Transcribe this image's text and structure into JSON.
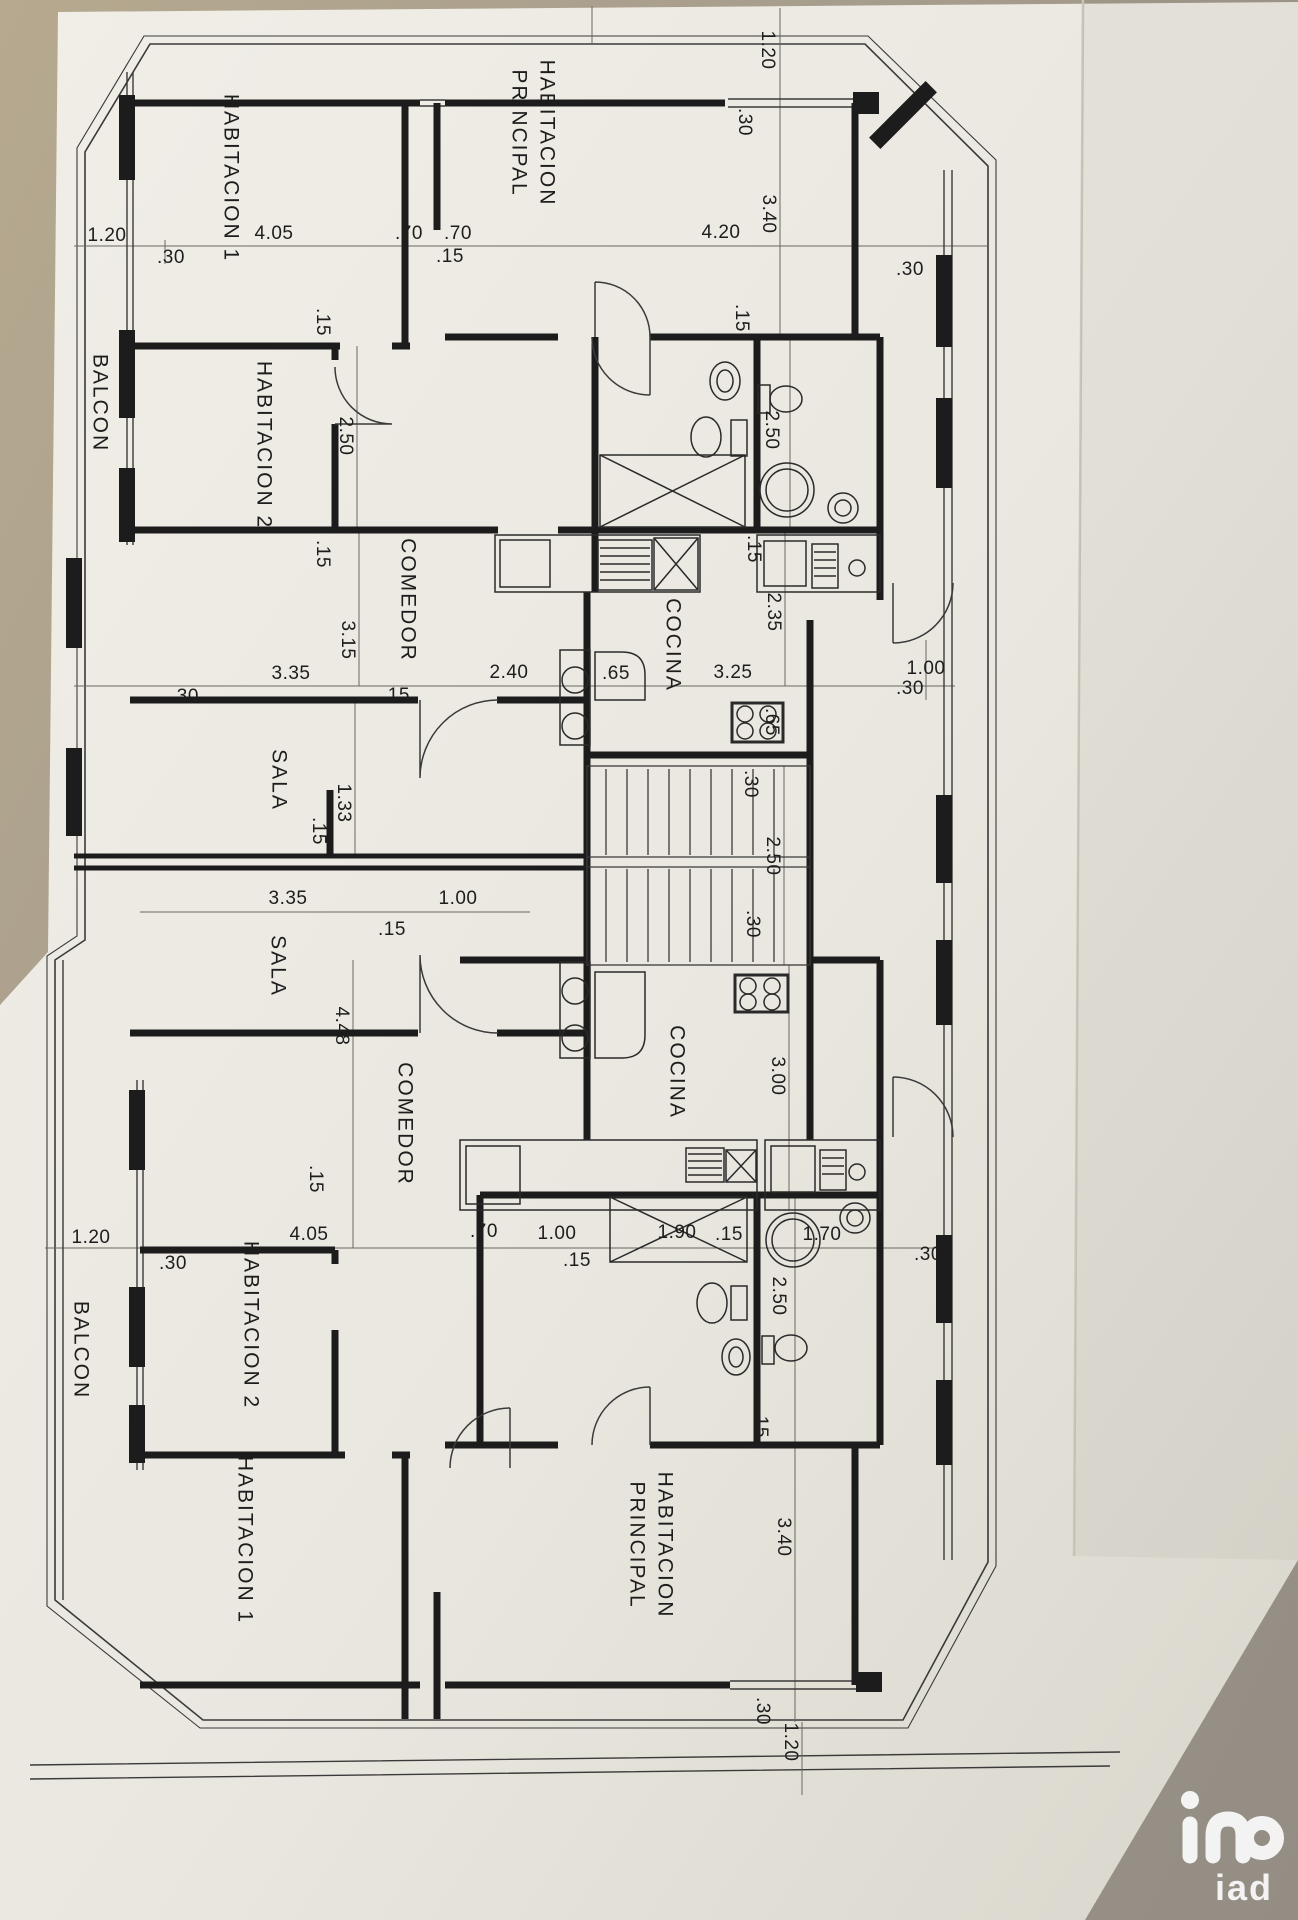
{
  "scene": {
    "table_color": "#a89e8d",
    "paper_color": "#eceae2",
    "wall_color": "#1c1c1c",
    "thin_line_color": "#3a3a3a",
    "dim_line_color": "#6a675f",
    "watermark_color": "#ffffff"
  },
  "watermark": {
    "text": "iad"
  },
  "plan": {
    "room_labels": [
      {
        "text": "HABITACION 1",
        "x": 230,
        "y": 178,
        "rot": 90
      },
      {
        "text": "PRINCIPAL",
        "x": 518,
        "y": 133,
        "rot": 90
      },
      {
        "text": "HABITACION",
        "x": 546,
        "y": 133,
        "rot": 90
      },
      {
        "text": "HABITACION 2",
        "x": 263,
        "y": 445,
        "rot": 90
      },
      {
        "text": "COMEDOR",
        "x": 407,
        "y": 600,
        "rot": 90
      },
      {
        "text": "COCINA",
        "x": 672,
        "y": 645,
        "rot": 90
      },
      {
        "text": "SALA",
        "x": 278,
        "y": 780,
        "rot": 90
      },
      {
        "text": "SALA",
        "x": 277,
        "y": 966,
        "rot": 90
      },
      {
        "text": "COCINA",
        "x": 676,
        "y": 1072,
        "rot": 90
      },
      {
        "text": "COMEDOR",
        "x": 404,
        "y": 1124,
        "rot": 90
      },
      {
        "text": "HABITACION 2",
        "x": 250,
        "y": 1325,
        "rot": 90
      },
      {
        "text": "HABITACION 1",
        "x": 244,
        "y": 1540,
        "rot": 90
      },
      {
        "text": "PRINCIPAL",
        "x": 636,
        "y": 1545,
        "rot": 90
      },
      {
        "text": "HABITACION",
        "x": 664,
        "y": 1545,
        "rot": 90
      },
      {
        "text": "BALCON",
        "x": 99,
        "y": 403,
        "rot": 90
      },
      {
        "text": "BALCON",
        "x": 80,
        "y": 1350,
        "rot": 90
      }
    ],
    "dim_labels": [
      {
        "text": "1.20",
        "x": 107,
        "y": 236,
        "rot": 0
      },
      {
        "text": ".30",
        "x": 171,
        "y": 258,
        "rot": 0
      },
      {
        "text": "4.05",
        "x": 274,
        "y": 234,
        "rot": 0
      },
      {
        "text": ".70",
        "x": 409,
        "y": 234,
        "rot": 0
      },
      {
        "text": ".70",
        "x": 458,
        "y": 234,
        "rot": 0
      },
      {
        "text": ".15",
        "x": 450,
        "y": 257,
        "rot": 0
      },
      {
        "text": "4.20",
        "x": 721,
        "y": 233,
        "rot": 0
      },
      {
        "text": "1.20",
        "x": 767,
        "y": 50,
        "rot": 90
      },
      {
        "text": ".30",
        "x": 744,
        "y": 122,
        "rot": 90
      },
      {
        "text": "3.40",
        "x": 768,
        "y": 214,
        "rot": 90
      },
      {
        "text": ".30",
        "x": 910,
        "y": 270,
        "rot": 0
      },
      {
        "text": ".15",
        "x": 322,
        "y": 322,
        "rot": 90
      },
      {
        "text": "2.50",
        "x": 345,
        "y": 436,
        "rot": 90
      },
      {
        "text": ".15",
        "x": 322,
        "y": 554,
        "rot": 90
      },
      {
        "text": ".15",
        "x": 741,
        "y": 318,
        "rot": 90
      },
      {
        "text": "2.50",
        "x": 771,
        "y": 430,
        "rot": 90
      },
      {
        "text": ".15",
        "x": 753,
        "y": 549,
        "rot": 90
      },
      {
        "text": "2.35",
        "x": 773,
        "y": 612,
        "rot": 90
      },
      {
        "text": "3.35",
        "x": 291,
        "y": 674,
        "rot": 0
      },
      {
        "text": "3.15",
        "x": 347,
        "y": 640,
        "rot": 90
      },
      {
        "text": ".30",
        "x": 185,
        "y": 697,
        "rot": 0
      },
      {
        "text": ".15",
        "x": 396,
        "y": 696,
        "rot": 0
      },
      {
        "text": "2.40",
        "x": 509,
        "y": 673,
        "rot": 0
      },
      {
        "text": ".65",
        "x": 616,
        "y": 674,
        "rot": 0
      },
      {
        "text": "3.25",
        "x": 733,
        "y": 673,
        "rot": 0
      },
      {
        "text": "1.00",
        "x": 926,
        "y": 669,
        "rot": 0
      },
      {
        "text": ".30",
        "x": 910,
        "y": 689,
        "rot": 0
      },
      {
        "text": ".65",
        "x": 771,
        "y": 722,
        "rot": 90
      },
      {
        "text": ".30",
        "x": 750,
        "y": 784,
        "rot": 90
      },
      {
        "text": "2.50",
        "x": 772,
        "y": 856,
        "rot": 90
      },
      {
        "text": ".30",
        "x": 752,
        "y": 924,
        "rot": 90
      },
      {
        "text": "1.33",
        "x": 343,
        "y": 803,
        "rot": 90
      },
      {
        "text": ".15",
        "x": 318,
        "y": 831,
        "rot": 90
      },
      {
        "text": "3.35",
        "x": 288,
        "y": 899,
        "rot": 0
      },
      {
        "text": "1.00",
        "x": 458,
        "y": 899,
        "rot": 0
      },
      {
        "text": ".15",
        "x": 392,
        "y": 930,
        "rot": 0
      },
      {
        "text": "4.48",
        "x": 341,
        "y": 1026,
        "rot": 90
      },
      {
        "text": "3.00",
        "x": 777,
        "y": 1076,
        "rot": 90
      },
      {
        "text": ".15",
        "x": 315,
        "y": 1179,
        "rot": 90
      },
      {
        "text": "1.20",
        "x": 91,
        "y": 1238,
        "rot": 0
      },
      {
        "text": ".30",
        "x": 173,
        "y": 1264,
        "rot": 0
      },
      {
        "text": "4.05",
        "x": 309,
        "y": 1235,
        "rot": 0
      },
      {
        "text": ".70",
        "x": 484,
        "y": 1232,
        "rot": 0
      },
      {
        "text": "1.00",
        "x": 557,
        "y": 1234,
        "rot": 0
      },
      {
        "text": ".15",
        "x": 577,
        "y": 1261,
        "rot": 0
      },
      {
        "text": "1.90",
        "x": 677,
        "y": 1233,
        "rot": 0
      },
      {
        "text": ".15",
        "x": 729,
        "y": 1235,
        "rot": 0
      },
      {
        "text": "1.70",
        "x": 822,
        "y": 1235,
        "rot": 0
      },
      {
        "text": ".30",
        "x": 928,
        "y": 1255,
        "rot": 0
      },
      {
        "text": "2.50",
        "x": 778,
        "y": 1296,
        "rot": 90
      },
      {
        "text": ".15",
        "x": 760,
        "y": 1424,
        "rot": 90
      },
      {
        "text": "3.40",
        "x": 783,
        "y": 1537,
        "rot": 90
      },
      {
        "text": ".30",
        "x": 762,
        "y": 1711,
        "rot": 90
      },
      {
        "text": "1.20",
        "x": 790,
        "y": 1742,
        "rot": 90
      }
    ]
  }
}
